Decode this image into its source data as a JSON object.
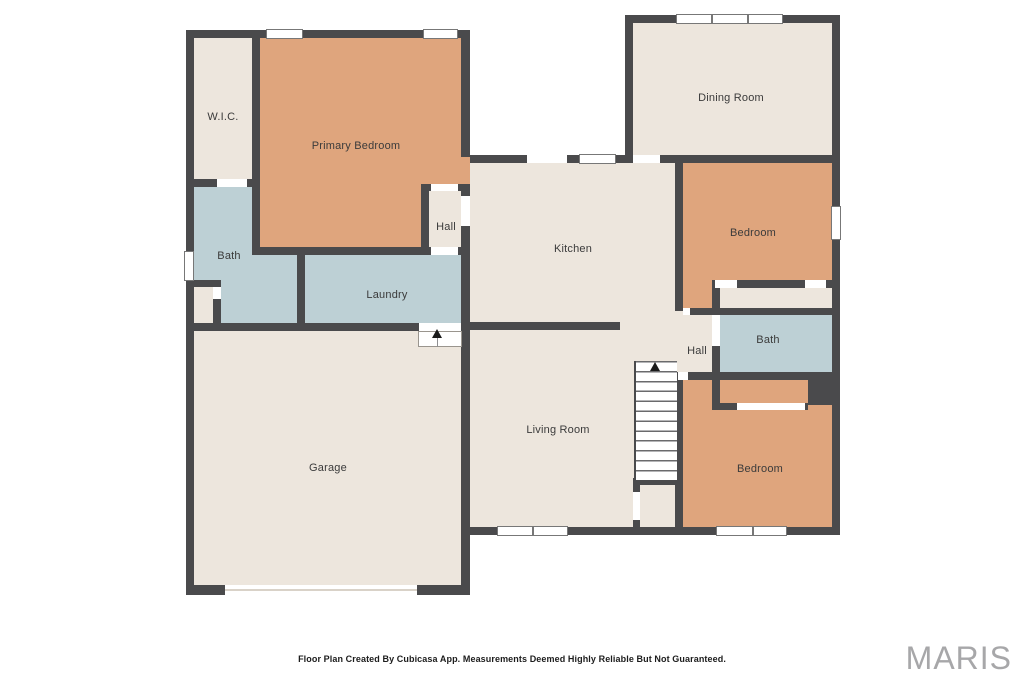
{
  "floorplan": {
    "rooms": {
      "wic": {
        "label": "W.I.C."
      },
      "primary_bedroom": {
        "label": "Primary Bedroom"
      },
      "dining_room": {
        "label": "Dining Room"
      },
      "hall_upper": {
        "label": "Hall"
      },
      "kitchen": {
        "label": "Kitchen"
      },
      "bedroom_top": {
        "label": "Bedroom"
      },
      "bath_left": {
        "label": "Bath"
      },
      "laundry": {
        "label": "Laundry"
      },
      "bath_right": {
        "label": "Bath"
      },
      "hall_right": {
        "label": "Hall"
      },
      "garage": {
        "label": "Garage"
      },
      "living_room": {
        "label": "Living Room"
      },
      "bedroom_bottom": {
        "label": "Bedroom"
      }
    },
    "colors": {
      "wall": "#4a4a4c",
      "bedroom": "#dfa57d",
      "wet": "#bdd0d5",
      "floor": "#ede6dd",
      "exterior": "#ffffff"
    },
    "footer": {
      "disclaimer": "Floor Plan Created By Cubicasa App. Measurements Deemed Highly Reliable But Not Guaranteed."
    },
    "branding": {
      "logo_text": "MARIS"
    }
  }
}
